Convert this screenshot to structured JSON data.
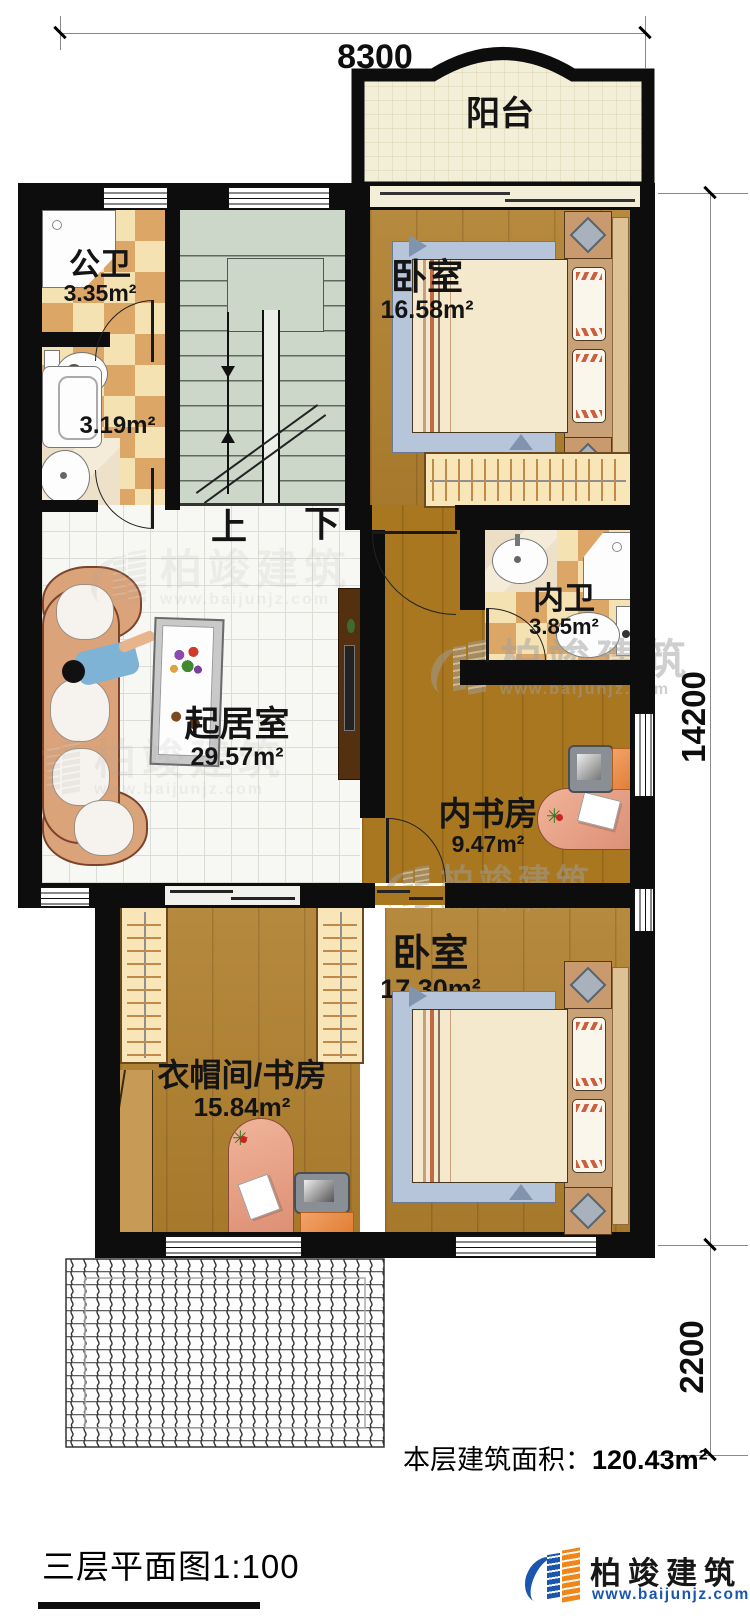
{
  "dimensions": {
    "width_top": "8300",
    "height_main": "14200",
    "height_terrace": "2200"
  },
  "rooms": {
    "balcony": {
      "name": "阳台"
    },
    "public_bath": {
      "name": "公卫",
      "area": "3.35m²"
    },
    "utility": {
      "area": "3.19m²"
    },
    "bedroom_top": {
      "name": "卧室",
      "area": "16.58m²"
    },
    "inner_bath": {
      "name": "内卫",
      "area": "3.85m²"
    },
    "living_room": {
      "name": "起居室",
      "area": "29.57m²"
    },
    "inner_study": {
      "name": "内书房",
      "area": "9.47m²"
    },
    "cloakroom_study": {
      "name": "衣帽间/书房",
      "area": "15.84m²"
    },
    "bedroom_bottom": {
      "name": "卧室",
      "area": "17.30m²"
    }
  },
  "stairs": {
    "up_label": "上",
    "down_label": "下"
  },
  "footer": {
    "floor_area_label": "本层建筑面积：",
    "floor_area_value": "120.43m²",
    "plan_title": "三层平面图1:100",
    "brand_name": "柏竣建筑",
    "brand_site": "www.baijunjz.com"
  },
  "watermark": {
    "brand_name": "柏竣建筑",
    "brand_site": "www.baijunjz.com"
  },
  "colors": {
    "wall": "#0d0d0d",
    "wood_floor": "#b0802e",
    "tile_light": "#f5e2b3",
    "tile_dark": "#dca766",
    "stair_floor": "#ccd7ca",
    "balcony_floor": "#f2eed8",
    "living_tile": "#f7f7f4",
    "logo_blue": "#1a56b0",
    "logo_orange": "#f08519"
  }
}
